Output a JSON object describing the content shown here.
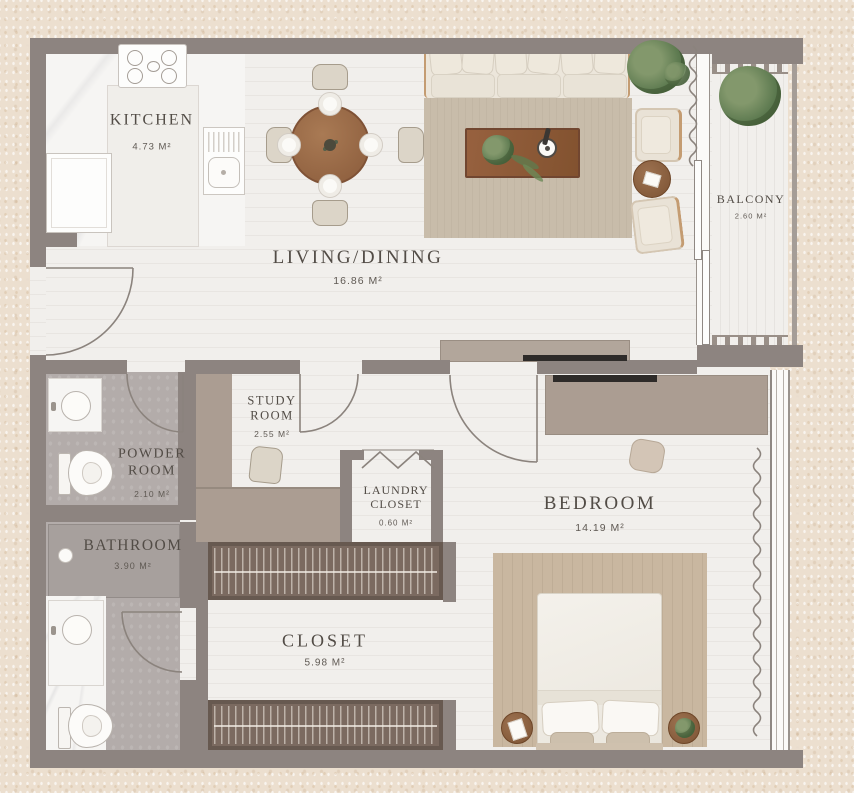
{
  "rooms": {
    "kitchen": {
      "name": "KITCHEN",
      "area": "4.73 M²"
    },
    "living_dining": {
      "name": "LIVING/DINING",
      "area": "16.86 M²"
    },
    "balcony": {
      "name": "BALCONY",
      "area": "2.60 M²"
    },
    "powder_room": {
      "name": "POWDER ROOM",
      "area": "2.10 M²"
    },
    "study_room": {
      "name": "STUDY ROOM",
      "area": "2.55 M²"
    },
    "laundry_closet": {
      "name": "LAUNDRY CLOSET",
      "area": "0.60 M²"
    },
    "bathroom": {
      "name": "BATHROOM",
      "area": "3.90 M²"
    },
    "closet": {
      "name": "CLOSET",
      "area": "5.98 M²"
    },
    "bedroom": {
      "name": "BEDROOM",
      "area": "14.19 M²"
    }
  },
  "colors": {
    "page_bg": "#ecdfcf",
    "wall": "#8d8480",
    "taupe": "#ab9d92",
    "floor": "#f1efec",
    "marble": "#f6f5f3",
    "gray_floor": "#b3acaa",
    "shower": "#a7a09d",
    "wood": "#9a6947",
    "wood_dark": "#7f5236",
    "rug_living": "#c8bcaa",
    "rug_bedroom": "#c9b7a0",
    "sofa_cream": "#ece6db",
    "frame_tan": "#c49c72",
    "wardrobe": "#7b6a60",
    "wardrobe_dark": "#675950",
    "plant_green": "#5d7a50",
    "tv_black": "#2e2b29",
    "text": "#524c46",
    "text_muted": "#5f5953",
    "line": "#8b837d"
  }
}
